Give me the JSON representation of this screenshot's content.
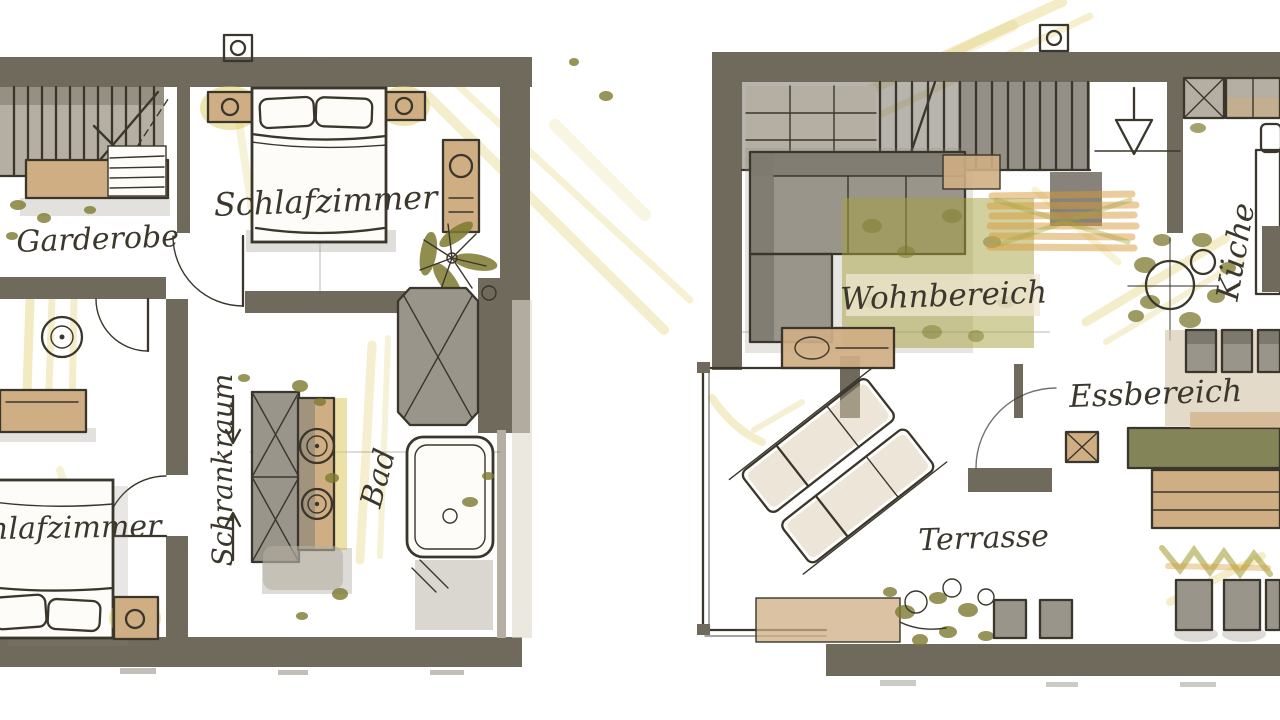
{
  "document_kind": "hand-drawn floor plan sketch, two storeys side by side",
  "palette": {
    "paper": "#ffffff",
    "wall": "#6F6A5C",
    "wall_light": "#b4afa2",
    "furniture_tan": "#cfae83",
    "sofa_gray": "#9a958a",
    "rug_olive": "#a6a23d",
    "marker_yellow": "#d9c44f",
    "marker_amber": "#d89a3a",
    "leaf_olive": "#7d7a2f",
    "ink_line": "#3a362c",
    "handwriting": "#3b372c"
  },
  "icons": {
    "ceiling_fixture": "square-with-circle",
    "plant": "radial-leaves",
    "sink": "double-circle",
    "stairs_direction": "arrow"
  },
  "plans": {
    "left": {
      "rooms": {
        "garderobe": {
          "label": "Garderobe"
        },
        "schlafzimmer_top": {
          "label": "Schlafzimmer"
        },
        "schrankraum": {
          "label": "Schrankraum"
        },
        "bad": {
          "label": "Bad"
        },
        "schlafzimmer_bottom": {
          "label": "Schlafzimmer"
        }
      }
    },
    "right": {
      "rooms": {
        "wohnbereich": {
          "label": "Wohnbereich"
        },
        "kueche": {
          "label": "Küche"
        },
        "essbereich": {
          "label": "Essbereich"
        },
        "terrasse": {
          "label": "Terrasse"
        }
      }
    }
  }
}
